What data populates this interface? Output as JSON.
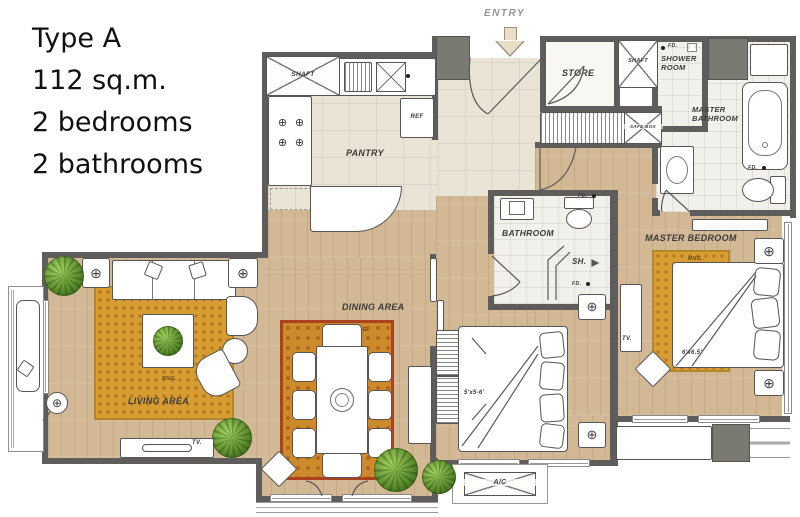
{
  "title": {
    "lines": [
      "Type A",
      "112 sq.m.",
      "2 bedrooms",
      "2 bathrooms"
    ]
  },
  "rooms": {
    "entry": "ENTRY",
    "shaft": "SHAFT",
    "store": "STORE",
    "shower_room": "SHOWER ROOM",
    "master_bathroom": "MASTER BATHROOM",
    "pantry": "PANTRY",
    "bathroom": "BATHROOM",
    "master_bedroom": "MASTER BEDROOM",
    "dining_area": "DINING AREA",
    "living_area": "LIVING AREA"
  },
  "ann": {
    "ref": "REF",
    "safe_box": "SAFE BOX",
    "sh": "SH.",
    "fd": "FD.",
    "tv": "TV.",
    "rng": "RNG.",
    "ac": "A/C",
    "master_bed_size": "6'x6.5'",
    "bed2_size": "5'x5-6'",
    "watermark": "ARISSARALAK",
    "lamp_symbol": "⊕",
    "burner_symbol": "⊕"
  },
  "colors": {
    "wall": "#5e5d5b",
    "wood_floor": "#d2b894",
    "tile_floor": "#eae4d6",
    "rug_gold": "#d79d33",
    "dining_rug_border": "#a8431d",
    "plant_green": "#4f7f24",
    "entry_arrow": "#eadfc6"
  }
}
